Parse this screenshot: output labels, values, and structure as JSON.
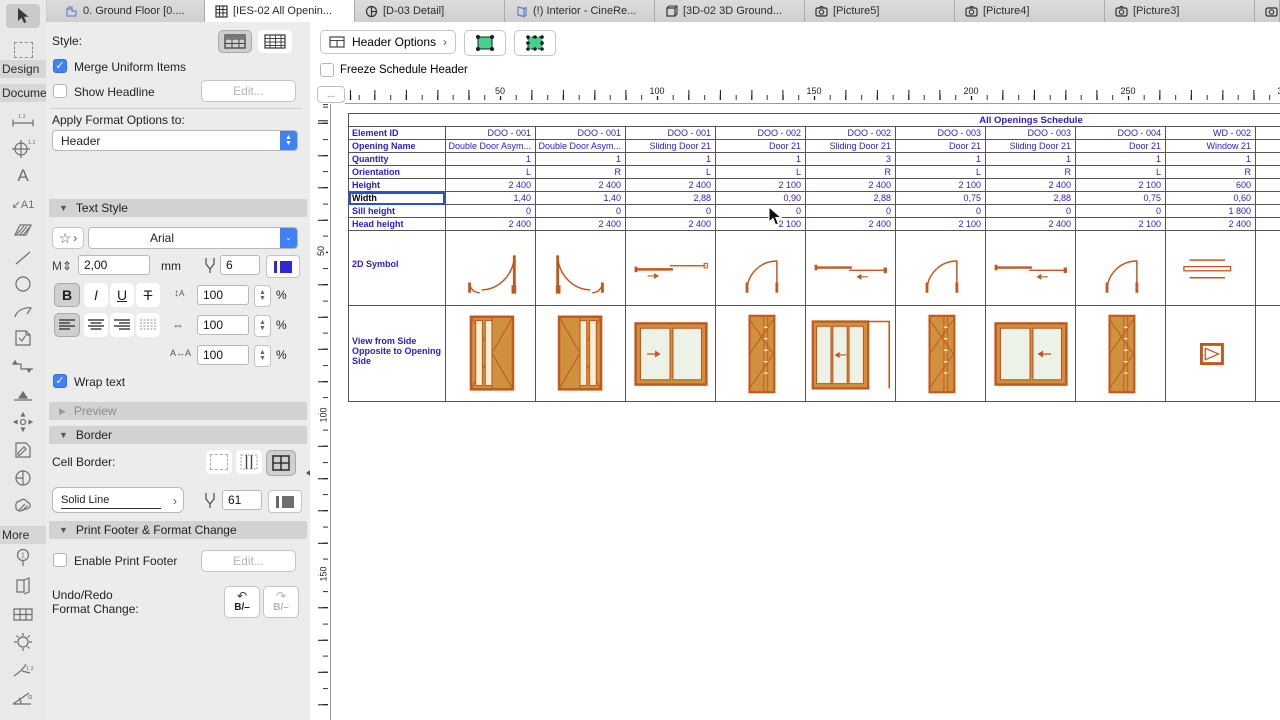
{
  "tabs": [
    {
      "label": "0. Ground Floor [0....",
      "icon": "floor-plan"
    },
    {
      "label": "[IES-02 All Openin...",
      "icon": "schedule",
      "active": true
    },
    {
      "label": "[D-03 Detail]",
      "icon": "detail"
    },
    {
      "label": "(!) Interior - CineRe...",
      "icon": "interior"
    },
    {
      "label": "[3D-02 3D Ground...",
      "icon": "3d"
    },
    {
      "label": "[Picture5]",
      "icon": "camera"
    },
    {
      "label": "[Picture4]",
      "icon": "camera"
    },
    {
      "label": "[Picture3]",
      "icon": "camera"
    },
    {
      "label": "",
      "icon": "camera"
    }
  ],
  "toolbox": {
    "design": "Design",
    "document": "Docume",
    "more": "More"
  },
  "sidebar": {
    "style_label": "Style:",
    "merge_uniform": "Merge Uniform Items",
    "show_headline": "Show Headline",
    "edit_button": "Edit...",
    "apply_format_label": "Apply Format Options to:",
    "apply_format_value": "Header",
    "text_style_title": "Text Style",
    "star_glyph": "☆",
    "chevron_glyph": "›",
    "font_name": "Arial",
    "font_size": "2,00",
    "font_size_unit": "mm",
    "font_pen": "6",
    "bold": "B",
    "italic": "I",
    "underline": "U",
    "strike": "T",
    "line_spacing": "100",
    "width_factor": "100",
    "tracking": "100",
    "percent": "%",
    "wrap_text": "Wrap text",
    "preview_title": "Preview",
    "border_title": "Border",
    "cell_border_label": "Cell Border:",
    "line_type": "Solid Line",
    "border_pen": "61",
    "print_footer_title": "Print Footer & Format Change",
    "enable_print_footer": "Enable Print Footer",
    "edit_button2": "Edit...",
    "undo_redo_line1": "Undo/Redo",
    "undo_redo_line2": "Format Change:",
    "undo_glyph": "B/–",
    "redo_glyph": "B/–"
  },
  "main": {
    "header_options_label": "Header Options",
    "freeze_label": "Freeze Schedule Header",
    "corner_button": "...",
    "ruler_h": [
      "50",
      "100",
      "150",
      "200",
      "250",
      "300"
    ],
    "ruler_v": [
      "50",
      "100",
      "150"
    ]
  },
  "schedule": {
    "title": "All Openings Schedule",
    "row_labels": [
      "Element ID",
      "Opening Name",
      "Quantity",
      "Orientation",
      "Height",
      "Width",
      "Sill height",
      "Head height"
    ],
    "selected_row_index": 5,
    "symbol_row_label": "2D Symbol",
    "view_row_label": "View from Side Opposite to Opening Side",
    "columns": [
      {
        "cells": [
          "DOO - 001",
          "Double Door Asym...",
          "1",
          "L",
          "2 400",
          "1,40",
          "0",
          "2 400"
        ],
        "symbol": "swing-double-a",
        "view": "door-glass-a"
      },
      {
        "cells": [
          "DOO - 001",
          "Double Door Asym...",
          "1",
          "R",
          "2 400",
          "1,40",
          "0",
          "2 400"
        ],
        "symbol": "swing-double-b",
        "view": "door-glass-b"
      },
      {
        "cells": [
          "DOO - 001",
          "Sliding Door 21",
          "1",
          "L",
          "2 400",
          "2,88",
          "0",
          "2 400"
        ],
        "symbol": "slide-r",
        "view": "slide-glass-r"
      },
      {
        "cells": [
          "DOO - 002",
          "Door 21",
          "1",
          "L",
          "2 100",
          "0,90",
          "0",
          "2 100"
        ],
        "symbol": "swing-single",
        "view": "panel-door"
      },
      {
        "cells": [
          "DOO - 002",
          "Sliding Door 21",
          "3",
          "R",
          "2 400",
          "2,88",
          "0",
          "2 400"
        ],
        "symbol": "slide-l",
        "view": "slide-pocket"
      },
      {
        "cells": [
          "DOO - 003",
          "Door 21",
          "1",
          "L",
          "2 100",
          "0,75",
          "0",
          "2 100"
        ],
        "symbol": "swing-single",
        "view": "panel-door"
      },
      {
        "cells": [
          "DOO - 003",
          "Sliding Door 21",
          "1",
          "R",
          "2 400",
          "2,88",
          "0",
          "2 400"
        ],
        "symbol": "slide-l",
        "view": "slide-glass-l"
      },
      {
        "cells": [
          "DOO - 004",
          "Door 21",
          "1",
          "L",
          "2 100",
          "0,75",
          "0",
          "2 100"
        ],
        "symbol": "swing-single",
        "view": "panel-door"
      },
      {
        "cells": [
          "WD - 002",
          "Window 21",
          "1",
          "R",
          "600",
          "0,60",
          "1 800",
          "2 400"
        ],
        "symbol": "window-sym",
        "view": "small-window"
      }
    ]
  },
  "colors": {
    "accent_blue": "#3f82f7",
    "table_text": "#2a1dc6",
    "symbol_orange": "#c2581d",
    "door_fill": "#d0913f",
    "glass": "#edf2e8",
    "green_button": "#45d08c"
  }
}
